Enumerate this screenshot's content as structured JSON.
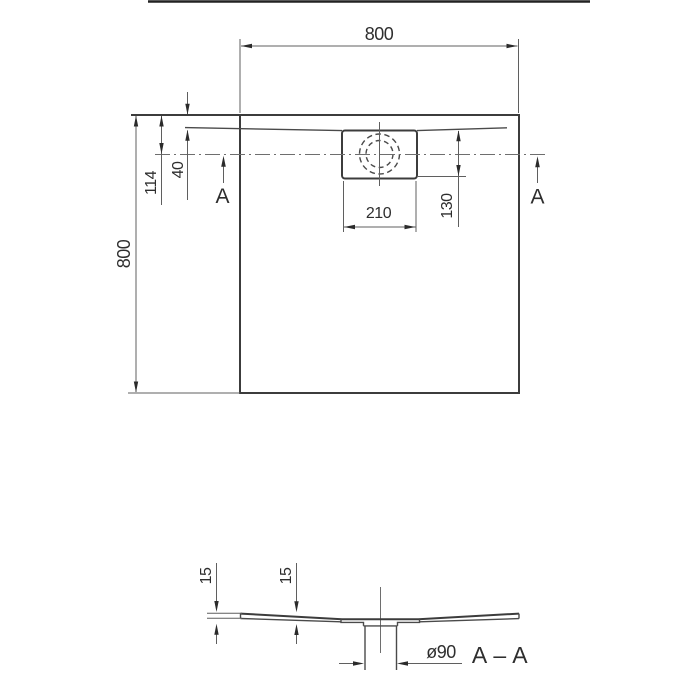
{
  "plan_view": {
    "width_label": "800",
    "height_label": "800",
    "edge_to_center_label": "114",
    "edge_to_rim_label": "40",
    "drain_width_label": "210",
    "drain_offset_label": "130",
    "section_arrow_left": "A",
    "section_arrow_right": "A"
  },
  "section_view": {
    "edge_thickness_label": "15",
    "inner_thickness_label": "15",
    "drain_diameter_label": "ø90",
    "section_name_label": "A – A"
  },
  "colors": {
    "line-strong": "#3c3c3c",
    "line-mid": "#4a4a4a",
    "line-thin": "#5f5f5f",
    "line-faint": "#6e6e6e",
    "text-color": "#2e2e2e",
    "bg": "#ffffff"
  }
}
